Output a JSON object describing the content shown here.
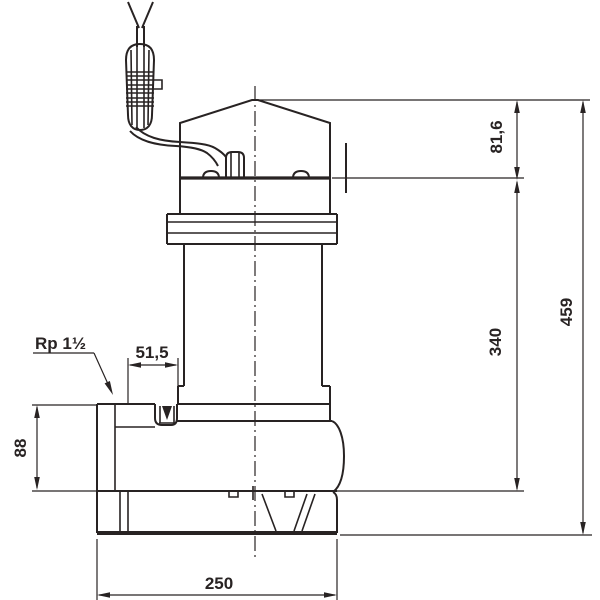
{
  "drawing_title": "pump-dimension-drawing",
  "colors": {
    "ink": "#282323",
    "background": "#ffffff"
  },
  "dims": {
    "total_height": "459",
    "motor_height": "340",
    "top_height": "81,6",
    "port_height": "88",
    "port_offset": "51,5",
    "base_width": "250"
  },
  "labels": {
    "port_thread": "Rp 1½"
  }
}
